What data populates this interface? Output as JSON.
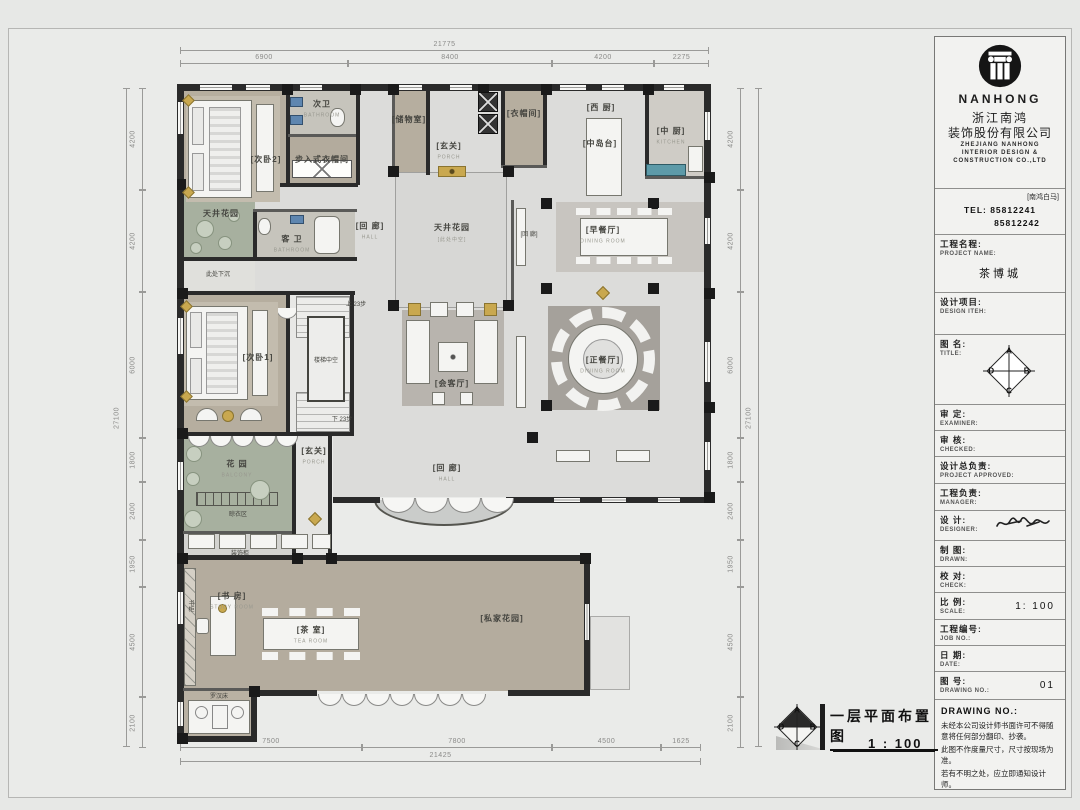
{
  "title_block": {
    "brand": "NANHONG",
    "company_cn_1": "浙江南鸿",
    "company_cn_2": "装饰股份有限公司",
    "company_en_1": "ZHEJIANG NANHONG",
    "company_en_2": "INTERIOR DESIGN &",
    "company_en_3": "CONSTRUCTION CO.,LTD",
    "branch": "[南鸿白马]",
    "tel_line_1": "TEL: 85812241",
    "tel_line_2": "85812242",
    "rows": [
      {
        "cn": "工程名程:",
        "en": "PROJECT NAME:",
        "val": "茶博城",
        "h": 58,
        "special": "name"
      },
      {
        "cn": "设计项目:",
        "en": "DESIGN ITEH:",
        "val": "",
        "h": 42,
        "special": ""
      },
      {
        "cn": "图  名:",
        "en": "TITLE:",
        "val": "",
        "h": 70,
        "special": "compass"
      },
      {
        "cn": "审  定:",
        "en": "EXAMINER:",
        "val": "",
        "h": 26,
        "special": ""
      },
      {
        "cn": "审  核:",
        "en": "CHECKED:",
        "val": "",
        "h": 26,
        "special": ""
      },
      {
        "cn": "设计总负责:",
        "en": "PROJECT APPROVED:",
        "val": "",
        "h": 27,
        "special": ""
      },
      {
        "cn": "工程负责:",
        "en": "MANAGER:",
        "val": "",
        "h": 27,
        "special": ""
      },
      {
        "cn": "设  计:",
        "en": "DESIGNER:",
        "val": "",
        "h": 30,
        "special": "signature"
      },
      {
        "cn": "制  图:",
        "en": "DRAWN:",
        "val": "",
        "h": 26,
        "special": ""
      },
      {
        "cn": "校  对:",
        "en": "CHECK:",
        "val": "",
        "h": 26,
        "special": ""
      },
      {
        "cn": "比  例:",
        "en": "SCALE:",
        "val": "1: 100",
        "h": 27,
        "special": "mid"
      },
      {
        "cn": "工程编号:",
        "en": "JOB  NO.:",
        "val": "",
        "h": 26,
        "special": ""
      },
      {
        "cn": "日  期:",
        "en": "DATE:",
        "val": "",
        "h": 26,
        "special": ""
      },
      {
        "cn": "图  号:",
        "en": "DRAWING NO.:",
        "val": "01",
        "h": 28,
        "special": "mid"
      }
    ],
    "notes_header": "DRAWING NO.:",
    "notes": [
      "未经本公司设计师书面许可不得随意将任何部分翻印、抄袭。",
      "此图不作度量尺寸，尺寸按现场为准。",
      "若有不明之处，应立即通知设计师。"
    ]
  },
  "compass": {
    "n": "A",
    "e": "B",
    "s": "C",
    "w": "D"
  },
  "plan_title": {
    "title": "一层平面布置图",
    "scale": "1 : 100"
  },
  "plan": {
    "labels": [
      {
        "id": "bedroom2",
        "t": "[次卧2]",
        "e": "",
        "x": 266,
        "y": 158
      },
      {
        "id": "bath2",
        "t": "次卫",
        "e": "BATHROOM",
        "x": 322,
        "y": 106
      },
      {
        "id": "walkin-closet",
        "t": "步入式衣帽间",
        "e": "",
        "x": 322,
        "y": 158
      },
      {
        "id": "storage",
        "t": "[储物室]",
        "e": "",
        "x": 409,
        "y": 118
      },
      {
        "id": "porch-top",
        "t": "[玄关]",
        "e": "PORCH",
        "x": 449,
        "y": 148
      },
      {
        "id": "cloakroom",
        "t": "[衣帽间]",
        "e": "",
        "x": 524,
        "y": 112
      },
      {
        "id": "west-kitchen",
        "t": "[西 厨]",
        "e": "",
        "x": 601,
        "y": 106
      },
      {
        "id": "island",
        "t": "[中岛台]",
        "e": "",
        "x": 600,
        "y": 142
      },
      {
        "id": "kitchen",
        "t": "[中 厨]",
        "e": "KITCHEN",
        "x": 671,
        "y": 133
      },
      {
        "id": "courtyard-small",
        "t": "天井花园",
        "e": "",
        "x": 221,
        "y": 212
      },
      {
        "id": "sunken",
        "t": "此处下沉",
        "e": "",
        "x": 218,
        "y": 272,
        "cls": "tiny"
      },
      {
        "id": "guest-bath",
        "t": "客 卫",
        "e": "BATHROOM",
        "x": 292,
        "y": 241
      },
      {
        "id": "hall-left",
        "t": "[回 廊]",
        "e": "HALL",
        "x": 370,
        "y": 228
      },
      {
        "id": "courtyard",
        "t": "天井花园",
        "e": "[此处中空]",
        "x": 452,
        "y": 230,
        "cls": "big"
      },
      {
        "id": "hall-right",
        "t": "[回 廊]",
        "e": "",
        "x": 529,
        "y": 232,
        "cls": "tiny"
      },
      {
        "id": "breakfast-room",
        "t": "[早餐厅]",
        "e": "DINING  ROOM",
        "x": 603,
        "y": 232
      },
      {
        "id": "dining-room",
        "t": "[正餐厅]",
        "e": "DINING  ROOM",
        "x": 603,
        "y": 362
      },
      {
        "id": "living-room",
        "t": "[会客厅]",
        "e": "",
        "x": 452,
        "y": 382
      },
      {
        "id": "bedroom1",
        "t": "[次卧1]",
        "e": "",
        "x": 258,
        "y": 356
      },
      {
        "id": "stair-void",
        "t": "楼梯中空",
        "e": "",
        "x": 326,
        "y": 358,
        "cls": "tiny"
      },
      {
        "id": "stair-up",
        "t": "上  23步",
        "e": "",
        "x": 356,
        "y": 302,
        "cls": "tiny"
      },
      {
        "id": "stair-down",
        "t": "下  23步",
        "e": "",
        "x": 342,
        "y": 417,
        "cls": "tiny"
      },
      {
        "id": "porch-bottom",
        "t": "[玄关]",
        "e": "PORCH",
        "x": 314,
        "y": 453
      },
      {
        "id": "garden",
        "t": "花 园",
        "e": "BALCONY",
        "x": 237,
        "y": 466
      },
      {
        "id": "drying-area",
        "t": "晾衣区",
        "e": "",
        "x": 238,
        "y": 512,
        "cls": "tiny"
      },
      {
        "id": "decor-cabinet",
        "t": "装饰柜",
        "e": "",
        "x": 240,
        "y": 551,
        "cls": "tiny"
      },
      {
        "id": "study",
        "t": "[书 房]",
        "e": "STUDY  ROOM",
        "x": 232,
        "y": 598
      },
      {
        "id": "bookcase",
        "t": "书柜",
        "e": "",
        "x": 190,
        "y": 606,
        "cls": "tiny vert"
      },
      {
        "id": "tea-room",
        "t": "[茶 室]",
        "e": "TEA  ROOM",
        "x": 311,
        "y": 632
      },
      {
        "id": "daybed",
        "t": "罗汉床",
        "e": "",
        "x": 219,
        "y": 694,
        "cls": "tiny"
      },
      {
        "id": "private-garden",
        "t": "[私家花园]",
        "e": "",
        "x": 502,
        "y": 617
      },
      {
        "id": "hall-bottom",
        "t": "[回 廊]",
        "e": "HALL",
        "x": 447,
        "y": 470
      }
    ],
    "hdims": [
      {
        "x1": 180,
        "x2": 709,
        "y": 50,
        "v": "21775"
      },
      {
        "x1": 180,
        "x2": 348,
        "y": 63,
        "v": "6900"
      },
      {
        "x1": 348,
        "x2": 552,
        "y": 63,
        "v": "8400"
      },
      {
        "x1": 552,
        "x2": 654,
        "y": 63,
        "v": "4200"
      },
      {
        "x1": 654,
        "x2": 709,
        "y": 63,
        "v": "2275"
      },
      {
        "x1": 180,
        "x2": 362,
        "y": 747,
        "v": "7500"
      },
      {
        "x1": 362,
        "x2": 552,
        "y": 747,
        "v": "7800"
      },
      {
        "x1": 552,
        "x2": 661,
        "y": 747,
        "v": "4500"
      },
      {
        "x1": 661,
        "x2": 701,
        "y": 747,
        "v": "1625"
      },
      {
        "x1": 180,
        "x2": 701,
        "y": 761,
        "v": "21425"
      }
    ],
    "vdims": [
      {
        "y1": 88,
        "y2": 747,
        "x": 126,
        "v": "27100"
      },
      {
        "y1": 88,
        "y2": 190,
        "x": 142,
        "v": "4200"
      },
      {
        "y1": 190,
        "y2": 292,
        "x": 142,
        "v": "4200"
      },
      {
        "y1": 292,
        "y2": 438,
        "x": 142,
        "v": "6000"
      },
      {
        "y1": 438,
        "y2": 482,
        "x": 142,
        "v": "1800"
      },
      {
        "y1": 482,
        "y2": 540,
        "x": 142,
        "v": "2400"
      },
      {
        "y1": 540,
        "y2": 587,
        "x": 142,
        "v": "1950"
      },
      {
        "y1": 587,
        "y2": 697,
        "x": 142,
        "v": "4500"
      },
      {
        "y1": 697,
        "y2": 748,
        "x": 142,
        "v": "2100"
      },
      {
        "y1": 88,
        "y2": 190,
        "x": 740,
        "v": "4200"
      },
      {
        "y1": 190,
        "y2": 292,
        "x": 740,
        "v": "4200"
      },
      {
        "y1": 292,
        "y2": 438,
        "x": 740,
        "v": "6000"
      },
      {
        "y1": 438,
        "y2": 482,
        "x": 740,
        "v": "1800"
      },
      {
        "y1": 482,
        "y2": 540,
        "x": 740,
        "v": "2400"
      },
      {
        "y1": 540,
        "y2": 587,
        "x": 740,
        "v": "1950"
      },
      {
        "y1": 587,
        "y2": 697,
        "x": 740,
        "v": "4500"
      },
      {
        "y1": 697,
        "y2": 748,
        "x": 740,
        "v": "2100"
      },
      {
        "y1": 88,
        "y2": 747,
        "x": 758,
        "v": "27100"
      }
    ],
    "colors": {
      "wall": "#2a2a2a",
      "marble": "#dcdcda",
      "bedroom": "#b6ae9f",
      "garden": "#a7b09f",
      "accent_gold": "#c9a84f",
      "accent_teal": "#5d9aa8"
    }
  }
}
